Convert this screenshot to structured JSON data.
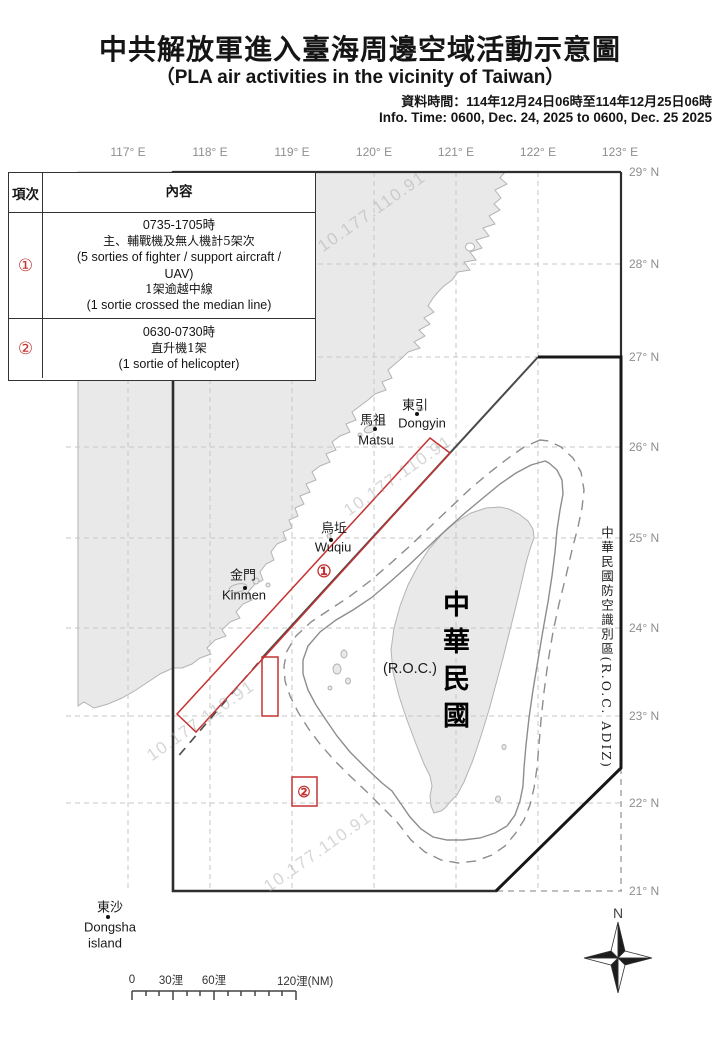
{
  "title": {
    "zh": "中共解放軍進入臺海周邊空域活動示意圖",
    "en": "（PLA air activities in the vicinity of Taiwan）"
  },
  "info": {
    "zh": "資料時間：114年12月24日06時至114年12月25日06時",
    "en": "Info. Time: 0600, Dec. 24, 2025 to 0600, Dec. 25 2025"
  },
  "table": {
    "headers": {
      "index": "項次",
      "content": "內容"
    },
    "rows": [
      {
        "num": "①",
        "lines": [
          "0735-1705時",
          "主、輔戰機及無人機計5架次",
          "(5 sorties of fighter / support aircraft /",
          "UAV)",
          "1架逾越中線",
          "(1 sortie crossed the median line)"
        ]
      },
      {
        "num": "②",
        "lines": [
          "0630-0730時",
          "直升機1架",
          "(1 sortie of helicopter)"
        ]
      }
    ]
  },
  "map": {
    "lon_labels": [
      "117° E",
      "118° E",
      "119° E",
      "120° E",
      "121° E",
      "122° E",
      "123° E"
    ],
    "lat_labels": [
      "29° N",
      "28° N",
      "27° N",
      "26° N",
      "25° N",
      "24° N",
      "23° N",
      "22° N",
      "21° N"
    ],
    "places": {
      "dongyin_zh": "東引",
      "dongyin_en": "Dongyin",
      "matsu_zh": "馬祖",
      "matsu_en": "Matsu",
      "wuqiu_zh": "烏坵",
      "wuqiu_en": "Wuqiu",
      "kinmen_zh": "金門",
      "kinmen_en": "Kinmen",
      "dongsha_zh": "東沙",
      "dongsha_en": "Dongsha",
      "dongsha_en2": "island",
      "taiwan_zh": "中華民國",
      "taiwan_en": "(R.O.C.)"
    },
    "adiz_label": "中華民國防空識別區(R.O.C. ADIZ)",
    "markers": {
      "m1": "①",
      "m2": "②"
    },
    "compass_label": "N",
    "scale": {
      "t0": "0",
      "t30": "30浬",
      "t60": "60浬",
      "t120": "120浬(NM)"
    }
  },
  "watermark": "10.177.110.91",
  "colors": {
    "red": "#c53232",
    "frame": "#2e2e2e",
    "adiz": "#171717",
    "land": "#e9e9e9",
    "coast": "#b3b3b3",
    "contour": "#8d8d8d",
    "median": "#4a4a4a",
    "grid": "#c7c7c7",
    "axis_label": "#8e8e8e",
    "text": "#151515"
  }
}
